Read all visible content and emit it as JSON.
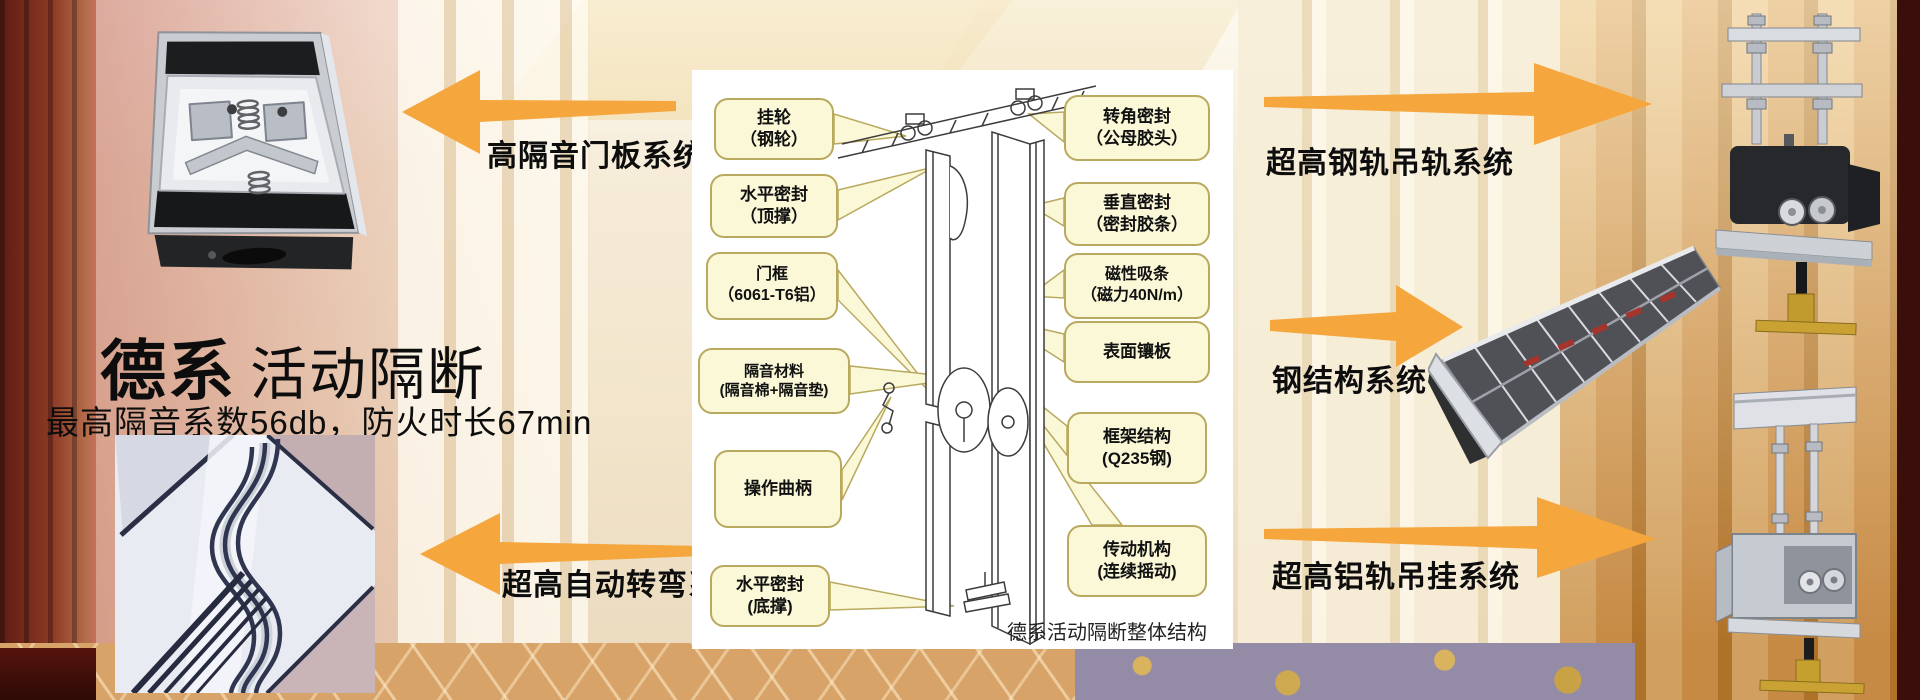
{
  "title": {
    "brand": "德系",
    "product": "活动隔断",
    "subtitle": "最高隔音系数56db，防火时长67min"
  },
  "systems": {
    "door_panel": "高隔音门板系统",
    "auto_turning": "超高自动转弯系统",
    "steel_rail": "超高钢轨吊轨系统",
    "steel_structure": "钢结构系统",
    "alu_rail": "超高铝轨吊挂系统"
  },
  "diagram": {
    "caption": "德系活动隔断整体结构",
    "callouts": [
      {
        "id": "hanging-wheel",
        "label": "挂轮\n（钢轮）"
      },
      {
        "id": "horizontal-seal-top",
        "label": "水平密封\n（顶撑）"
      },
      {
        "id": "door-frame",
        "label": "门框\n（6061-T6铝）"
      },
      {
        "id": "soundproof-material",
        "label": "隔音材料\n(隔音棉+隔音垫)"
      },
      {
        "id": "operating-crank",
        "label": "操作曲柄"
      },
      {
        "id": "horizontal-seal-bottom",
        "label": "水平密封\n(底撑)"
      },
      {
        "id": "corner-seal",
        "label": "转角密封\n（公母胶头）"
      },
      {
        "id": "vertical-seal",
        "label": "垂直密封\n（密封胶条）"
      },
      {
        "id": "magnetic-strip",
        "label": "磁性吸条\n（磁力40N/m）"
      },
      {
        "id": "surface-panel",
        "label": "表面镶板"
      },
      {
        "id": "frame-structure",
        "label": "框架结构\n(Q235钢)"
      },
      {
        "id": "transmission",
        "label": "传动机构\n(连续摇动)"
      }
    ]
  },
  "colors": {
    "arrow": "#F5A73E",
    "callout_bg": "#FBF8D8",
    "callout_border": "#B9A95E",
    "panel_bg": "#FFFFFF"
  }
}
